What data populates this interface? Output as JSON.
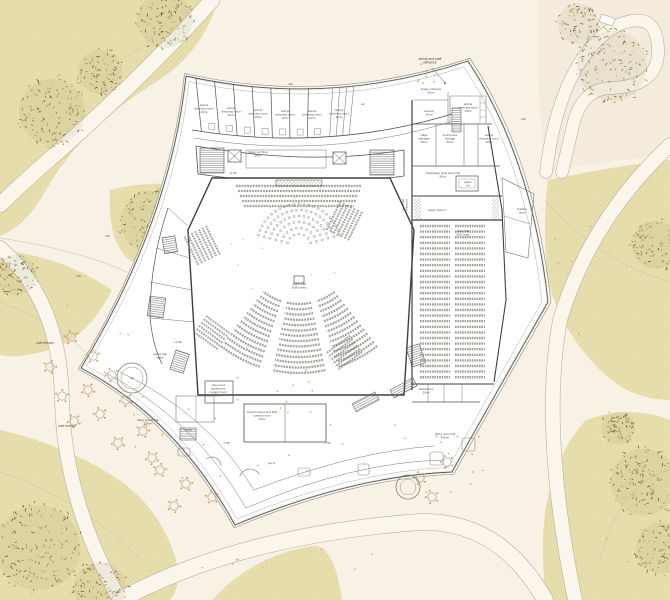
{
  "title": "concert hall site plan",
  "palette": {
    "background": "#f7f2e5",
    "path": "#faf6ec",
    "path_edge": "#b7b1a2",
    "field": "#e7dead",
    "field_dot": "#d6c98c",
    "pink_zone": "#f4ebdd",
    "building_fill": "#ffffff",
    "wall": "#3f3f3c",
    "thin_line": "#77756e",
    "seat": "#8a887f",
    "accent_orange": "#e09a52",
    "tree_palette": [
      "#8c8149",
      "#6e663a",
      "#a59a5f",
      "#57522f",
      "#998c4f"
    ]
  },
  "site": {
    "labels": [
      {
        "t": [
          "artists and staff",
          "entrance"
        ],
        "x": 430,
        "y": 60,
        "s": 3.4
      },
      {
        "t": [
          "cafe terrace"
        ],
        "x": 45,
        "y": 344,
        "s": 3.4
      },
      {
        "t": [
          "cafe terrace"
        ],
        "x": 67,
        "y": 427,
        "s": 3.4
      },
      {
        "t": [
          "+35"
        ],
        "x": 107,
        "y": 237,
        "s": 3.0
      },
      {
        "t": [
          "+30"
        ],
        "x": 78,
        "y": 277,
        "s": 3.0
      },
      {
        "t": [
          "+30"
        ],
        "x": 523,
        "y": 120,
        "s": 3.0
      },
      {
        "t": [
          "+30"
        ],
        "x": 290,
        "y": 85,
        "s": 3.0
      }
    ]
  },
  "building": {
    "room_labels": [
      {
        "t": [
          "artists",
          "dressing room",
          "16m²"
        ],
        "x": 204,
        "y": 106
      },
      {
        "t": [
          "artists",
          "dressing room",
          "16m²"
        ],
        "x": 231,
        "y": 109
      },
      {
        "t": [
          "artists",
          "dressing room",
          "16m²"
        ],
        "x": 258,
        "y": 111
      },
      {
        "t": [
          "artists",
          "dressing room",
          "16m²"
        ],
        "x": 285,
        "y": 112
      },
      {
        "t": [
          "artists",
          "dressing room",
          "16m²"
        ],
        "x": 312,
        "y": 112
      },
      {
        "t": [
          "artists",
          "dressing room",
          "16m²"
        ],
        "x": 339,
        "y": 111
      },
      {
        "t": [
          "wc"
        ],
        "x": 363,
        "y": 105
      },
      {
        "t": [
          "library archive",
          "30m²"
        ],
        "x": 258,
        "y": 153
      },
      {
        "t": [
          "stage entrance",
          "55m²"
        ],
        "x": 431,
        "y": 90
      },
      {
        "t": [
          "security",
          "15m²"
        ],
        "x": 429,
        "y": 112
      },
      {
        "t": [
          "artists",
          "dressing room",
          "18m²"
        ],
        "x": 468,
        "y": 105
      },
      {
        "t": [
          "stage",
          "manager",
          "15m²"
        ],
        "x": 424,
        "y": 136
      },
      {
        "t": [
          "instrument",
          "storage",
          "30m²"
        ],
        "x": 450,
        "y": 136
      },
      {
        "t": [
          "artists",
          "dressing room",
          "18m²"
        ],
        "x": 489,
        "y": 136
      },
      {
        "t": [
          "backstage area west hall",
          "90m²"
        ],
        "x": 443,
        "y": 174
      },
      {
        "t": [
          "piano",
          "lift"
        ],
        "x": 468,
        "y": 183
      },
      {
        "t": [
          "stage 120 m²"
        ],
        "x": 437,
        "y": 211
      },
      {
        "t": [
          "west hall",
          "500 seats"
        ],
        "x": 463,
        "y": 232
      },
      {
        "t": [
          "loading",
          "dock"
        ],
        "x": 522,
        "y": 210
      },
      {
        "t": [
          "west hall",
          "entrance"
        ],
        "x": 404,
        "y": 205,
        "r": -90
      },
      {
        "t": [
          "grand hall",
          "1800 seats"
        ],
        "x": 299,
        "y": 285
      },
      {
        "t": [
          "grand hall",
          "stairs"
        ],
        "x": 160,
        "y": 355
      },
      {
        "t": [
          "lobby grand hall",
          "760m²"
        ],
        "x": 148,
        "y": 421
      },
      {
        "t": [
          "bar"
        ],
        "x": 132,
        "y": 379
      },
      {
        "t": [
          "video and",
          "equipment",
          "control room",
          "15m²"
        ],
        "x": 218,
        "y": 386
      },
      {
        "t": [
          "closed sound and light",
          "control room",
          "16m²"
        ],
        "x": 262,
        "y": 413
      },
      {
        "t": [
          "bathrooms",
          "20m²"
        ],
        "x": 426,
        "y": 390
      },
      {
        "t": [
          "lobby west hall",
          "450m²"
        ],
        "x": 445,
        "y": 435
      }
    ],
    "level_labels": [
      {
        "t": [
          "+4.00"
        ],
        "x": 188,
        "y": 431
      },
      {
        "t": [
          "-7.50"
        ],
        "x": 226,
        "y": 444
      },
      {
        "t": [
          "-7.50"
        ],
        "x": 327,
        "y": 444
      },
      {
        "t": [
          "+4.0"
        ],
        "x": 272,
        "y": 464
      },
      {
        "t": [
          "+1.50"
        ],
        "x": 178,
        "y": 343
      },
      {
        "t": [
          "+1.50"
        ],
        "x": 233,
        "y": 174
      }
    ],
    "halls": {
      "grand_hall": {
        "name": "grand hall",
        "seats": "1800 seats"
      },
      "west_hall": {
        "name": "west hall",
        "seats": "500 seats"
      }
    }
  },
  "landscape": {
    "trees": [
      {
        "x": 52,
        "y": 112,
        "r": 36
      },
      {
        "x": 100,
        "y": 72,
        "r": 24
      },
      {
        "x": 165,
        "y": 20,
        "r": 30
      },
      {
        "x": 152,
        "y": 222,
        "r": 34
      },
      {
        "x": 16,
        "y": 275,
        "r": 22
      },
      {
        "x": 38,
        "y": 548,
        "r": 46
      },
      {
        "x": 100,
        "y": 588,
        "r": 28
      },
      {
        "x": 612,
        "y": 66,
        "r": 38
      },
      {
        "x": 578,
        "y": 24,
        "r": 22
      },
      {
        "x": 656,
        "y": 245,
        "r": 26
      },
      {
        "x": 644,
        "y": 482,
        "r": 36
      },
      {
        "x": 662,
        "y": 548,
        "r": 28
      },
      {
        "x": 618,
        "y": 428,
        "r": 18
      }
    ],
    "tables": [
      [
        71,
        337
      ],
      [
        50,
        367
      ],
      [
        93,
        356
      ],
      [
        62,
        396
      ],
      [
        88,
        390
      ],
      [
        112,
        375
      ],
      [
        74,
        421
      ],
      [
        100,
        414
      ],
      [
        126,
        400
      ],
      [
        143,
        431
      ],
      [
        118,
        443
      ],
      [
        152,
        458
      ],
      [
        160,
        470
      ],
      [
        186,
        484
      ],
      [
        212,
        497
      ],
      [
        174,
        506
      ],
      [
        420,
        478
      ],
      [
        447,
        462
      ],
      [
        432,
        497
      ]
    ],
    "kiosks": [
      [
        408,
        487,
        12
      ]
    ]
  }
}
